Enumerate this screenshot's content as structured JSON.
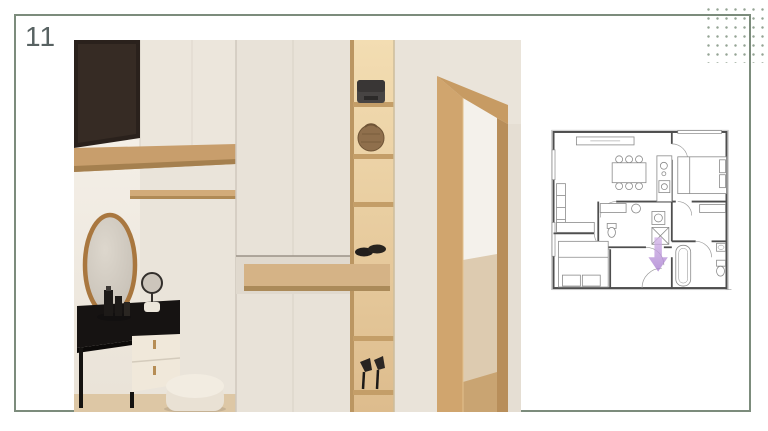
{
  "page": {
    "number": "11"
  },
  "theme": {
    "frame_color": "#7c8c7c",
    "dots_color": "#95a495",
    "page_number_color": "#586262",
    "background": "#ffffff"
  },
  "hero_image": {
    "description": "Interior render of an entryway: black TV panel and cream upper cabinets with wood shelf, tall cream wardrobe, open wood shelving column holding bags and shoes, pull-out wood drawer, round wood-framed mirror over a black vanity with cream drawers, small table mirror, cream pouf, and a wood door frame opening to another room",
    "palette": {
      "wall_cream": "#eae4da",
      "wood": "#cda26b",
      "dark_panel": "#2a211c",
      "floor": "#ddc7a5"
    }
  },
  "floor_plan": {
    "description": "Apartment floor plan: living-dining room with sofa and six-chair table, kitchen counter, two bedrooms with beds, central bathroom with washer and shower, lower bathroom with tub and toilet, entry hallway",
    "arrow_color": "#b58bd8",
    "wall_color": "#4e4e4e"
  }
}
